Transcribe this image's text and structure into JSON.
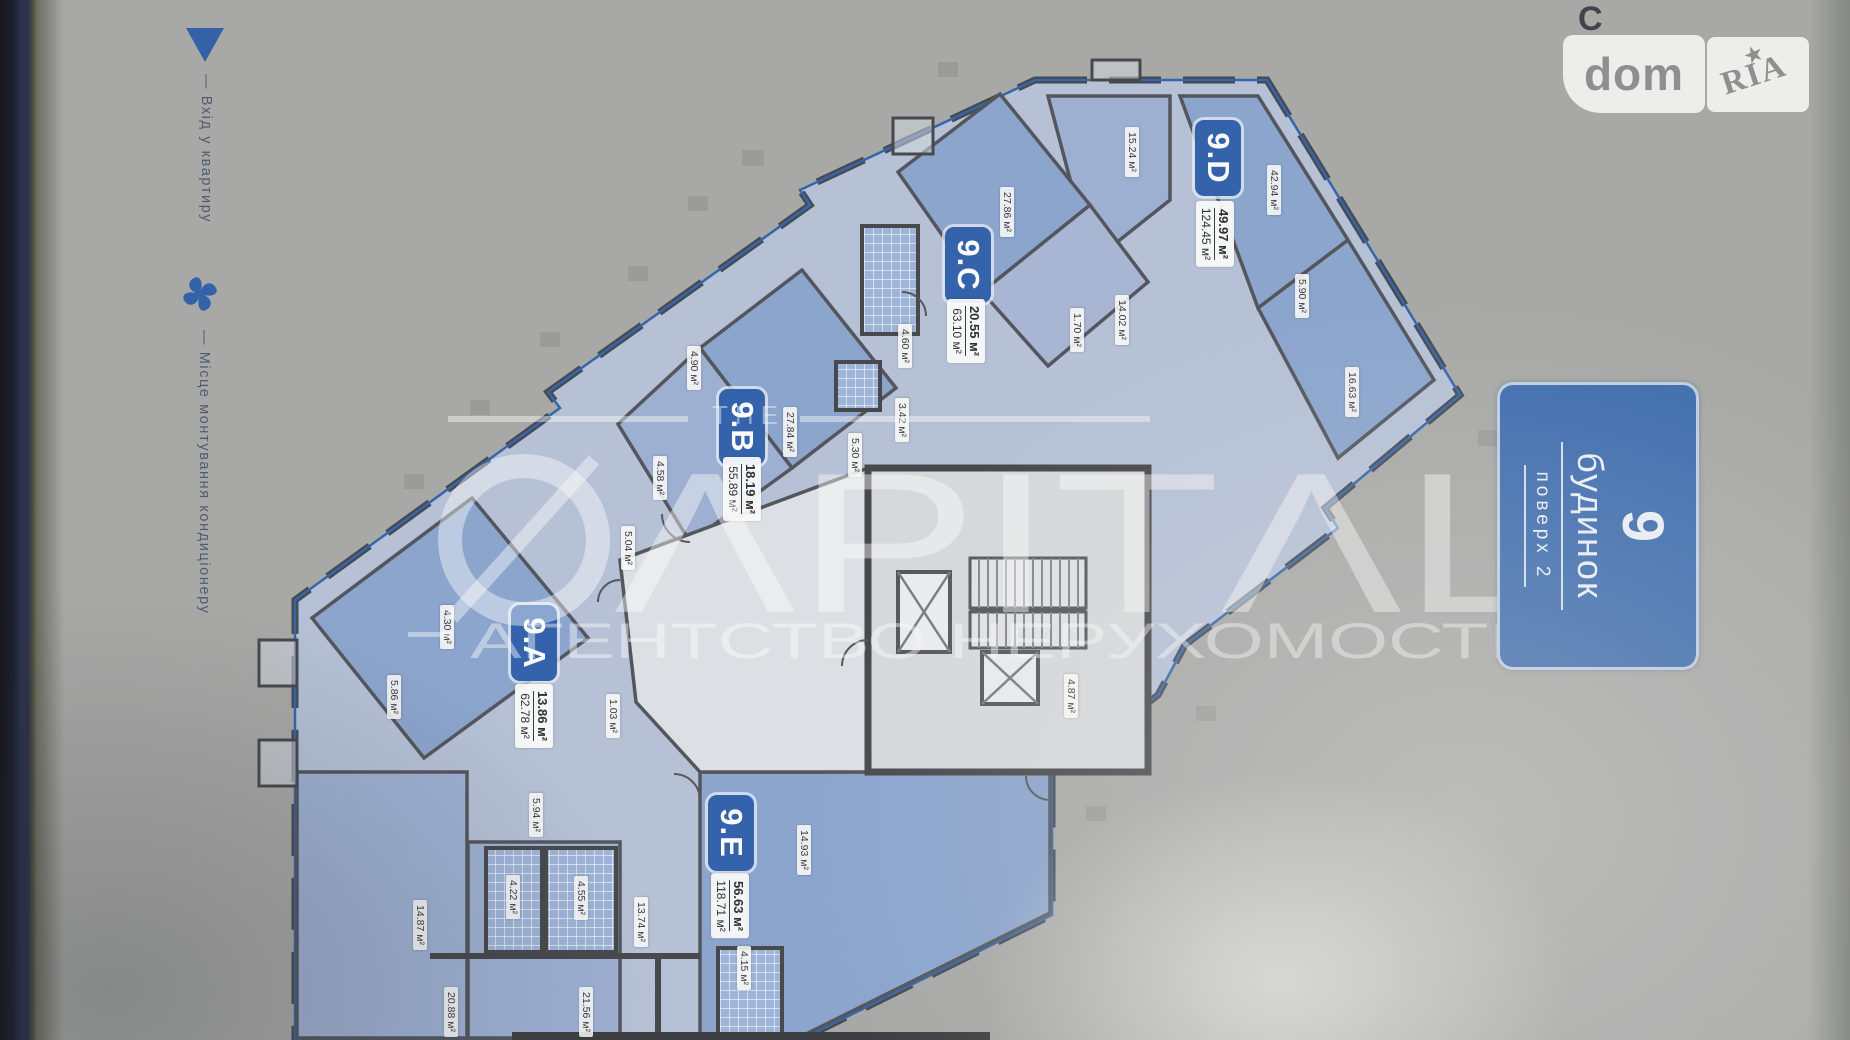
{
  "branding": {
    "background_glyph": "С",
    "logo_left": "dom",
    "logo_right": "RIA",
    "star": "★"
  },
  "legend": {
    "entrance_label": "— Вхід у квартиру",
    "ac_label": "— Місце монтування кондиціонеру"
  },
  "building_badge": {
    "number": "9",
    "building_label": "будинок",
    "floor_label": "поверх 2"
  },
  "watermark": {
    "the": "THE",
    "brand": "CAPITAL",
    "brand_display": "ΛPITΛL",
    "subtitle": "АГЕНТСТВО НЕРУХОМОСТІ"
  },
  "apartments": [
    {
      "id": "9.A",
      "area_live": "13.86 м²",
      "area_total": "62.78 м²",
      "x": 534,
      "y": 643,
      "ax": 534,
      "ay": 716
    },
    {
      "id": "9.B",
      "area_live": "18.19 м²",
      "area_total": "55.89 м²",
      "x": 742,
      "y": 427,
      "ax": 742,
      "ay": 489
    },
    {
      "id": "9.C",
      "area_live": "20.55 м²",
      "area_total": "63.10 м²",
      "x": 968,
      "y": 265,
      "ax": 966,
      "ay": 331
    },
    {
      "id": "9.D",
      "area_live": "49.97 м²",
      "area_total": "124.45 м²",
      "x": 1218,
      "y": 158,
      "ax": 1215,
      "ay": 234
    },
    {
      "id": "9.E",
      "area_live": "56.63 м²",
      "area_total": "118.71 м²",
      "x": 731,
      "y": 833,
      "ax": 730,
      "ay": 906
    }
  ],
  "room_labels": [
    {
      "value": "42.94 м²",
      "x": 1274,
      "y": 190
    },
    {
      "value": "15.24 м²",
      "x": 1132,
      "y": 152
    },
    {
      "value": "14.02 м²",
      "x": 1122,
      "y": 320
    },
    {
      "value": "5.90 м²",
      "x": 1302,
      "y": 296
    },
    {
      "value": "16.63 м²",
      "x": 1352,
      "y": 392
    },
    {
      "value": "27.86 м²",
      "x": 1007,
      "y": 212
    },
    {
      "value": "1.70 м²",
      "x": 1077,
      "y": 330
    },
    {
      "value": "4.60 м²",
      "x": 905,
      "y": 346
    },
    {
      "value": "3.42 м²",
      "x": 902,
      "y": 420
    },
    {
      "value": "5.30 м²",
      "x": 855,
      "y": 455
    },
    {
      "value": "27.84 м²",
      "x": 790,
      "y": 432
    },
    {
      "value": "4.90 м²",
      "x": 694,
      "y": 368
    },
    {
      "value": "4.58 м²",
      "x": 660,
      "y": 478
    },
    {
      "value": "5.04 м²",
      "x": 628,
      "y": 548
    },
    {
      "value": "1.03 м²",
      "x": 613,
      "y": 716
    },
    {
      "value": "4.30 м²",
      "x": 447,
      "y": 627
    },
    {
      "value": "5.86 м²",
      "x": 394,
      "y": 697
    },
    {
      "value": "14.87 м²",
      "x": 420,
      "y": 925
    },
    {
      "value": "5.94 м²",
      "x": 536,
      "y": 815
    },
    {
      "value": "4.22 м²",
      "x": 513,
      "y": 897
    },
    {
      "value": "4.55 м²",
      "x": 581,
      "y": 898
    },
    {
      "value": "13.74 м²",
      "x": 641,
      "y": 922
    },
    {
      "value": "14.93 м²",
      "x": 804,
      "y": 850
    },
    {
      "value": "4.87 м²",
      "x": 1071,
      "y": 696
    },
    {
      "value": "4.15 м²",
      "x": 744,
      "y": 968
    },
    {
      "value": "20.88 м²",
      "x": 451,
      "y": 1012
    },
    {
      "value": "21.56 м²",
      "x": 586,
      "y": 1012
    }
  ]
}
